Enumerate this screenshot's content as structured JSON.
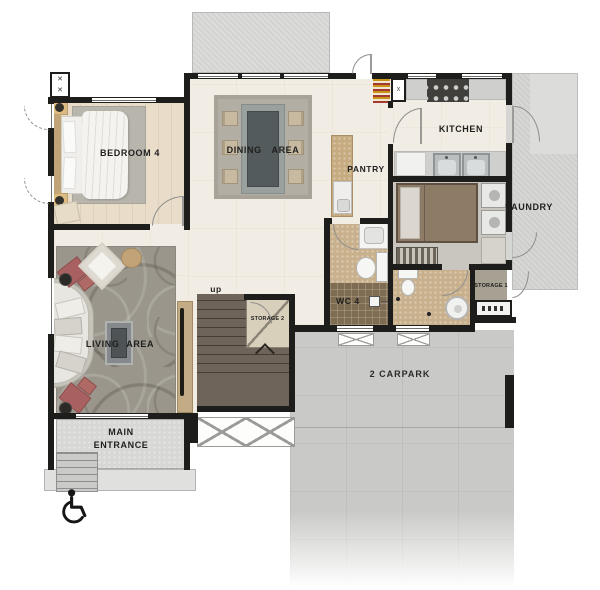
{
  "title": "single-storey house floor plan",
  "rooms": {
    "bedroom4": "BEDROOM 4",
    "dining": "DINING AREA",
    "kitchen": "KITCHEN",
    "pantry": "PANTRY",
    "laundry": "LAUNDRY",
    "wc4": "WC 4",
    "living": "LIVING AREA",
    "entrance_line1": "MAIN",
    "entrance_line2": "ENTRANCE",
    "carpark": "2 CARPARK",
    "storage1": "STORAGE 1",
    "storage2": "STORAGE 2"
  },
  "labels": {
    "stairs_up": "up"
  },
  "icons": {
    "accessible": "wheelchair-accessible-icon"
  },
  "colors": {
    "wall": "#1d1d1b",
    "floor_cream": "#f2ede4",
    "floor_wood": "#e9ddca",
    "concrete_carpark": "#c9c9c7",
    "terrace_gray": "#dadad8",
    "stairs_brown": "#6f6459",
    "bath_tan": "#c9b08c",
    "tile_brown": "#7e6c53",
    "sofa_accent_red": "#a96060",
    "counter_tan": "#c6ab80"
  }
}
